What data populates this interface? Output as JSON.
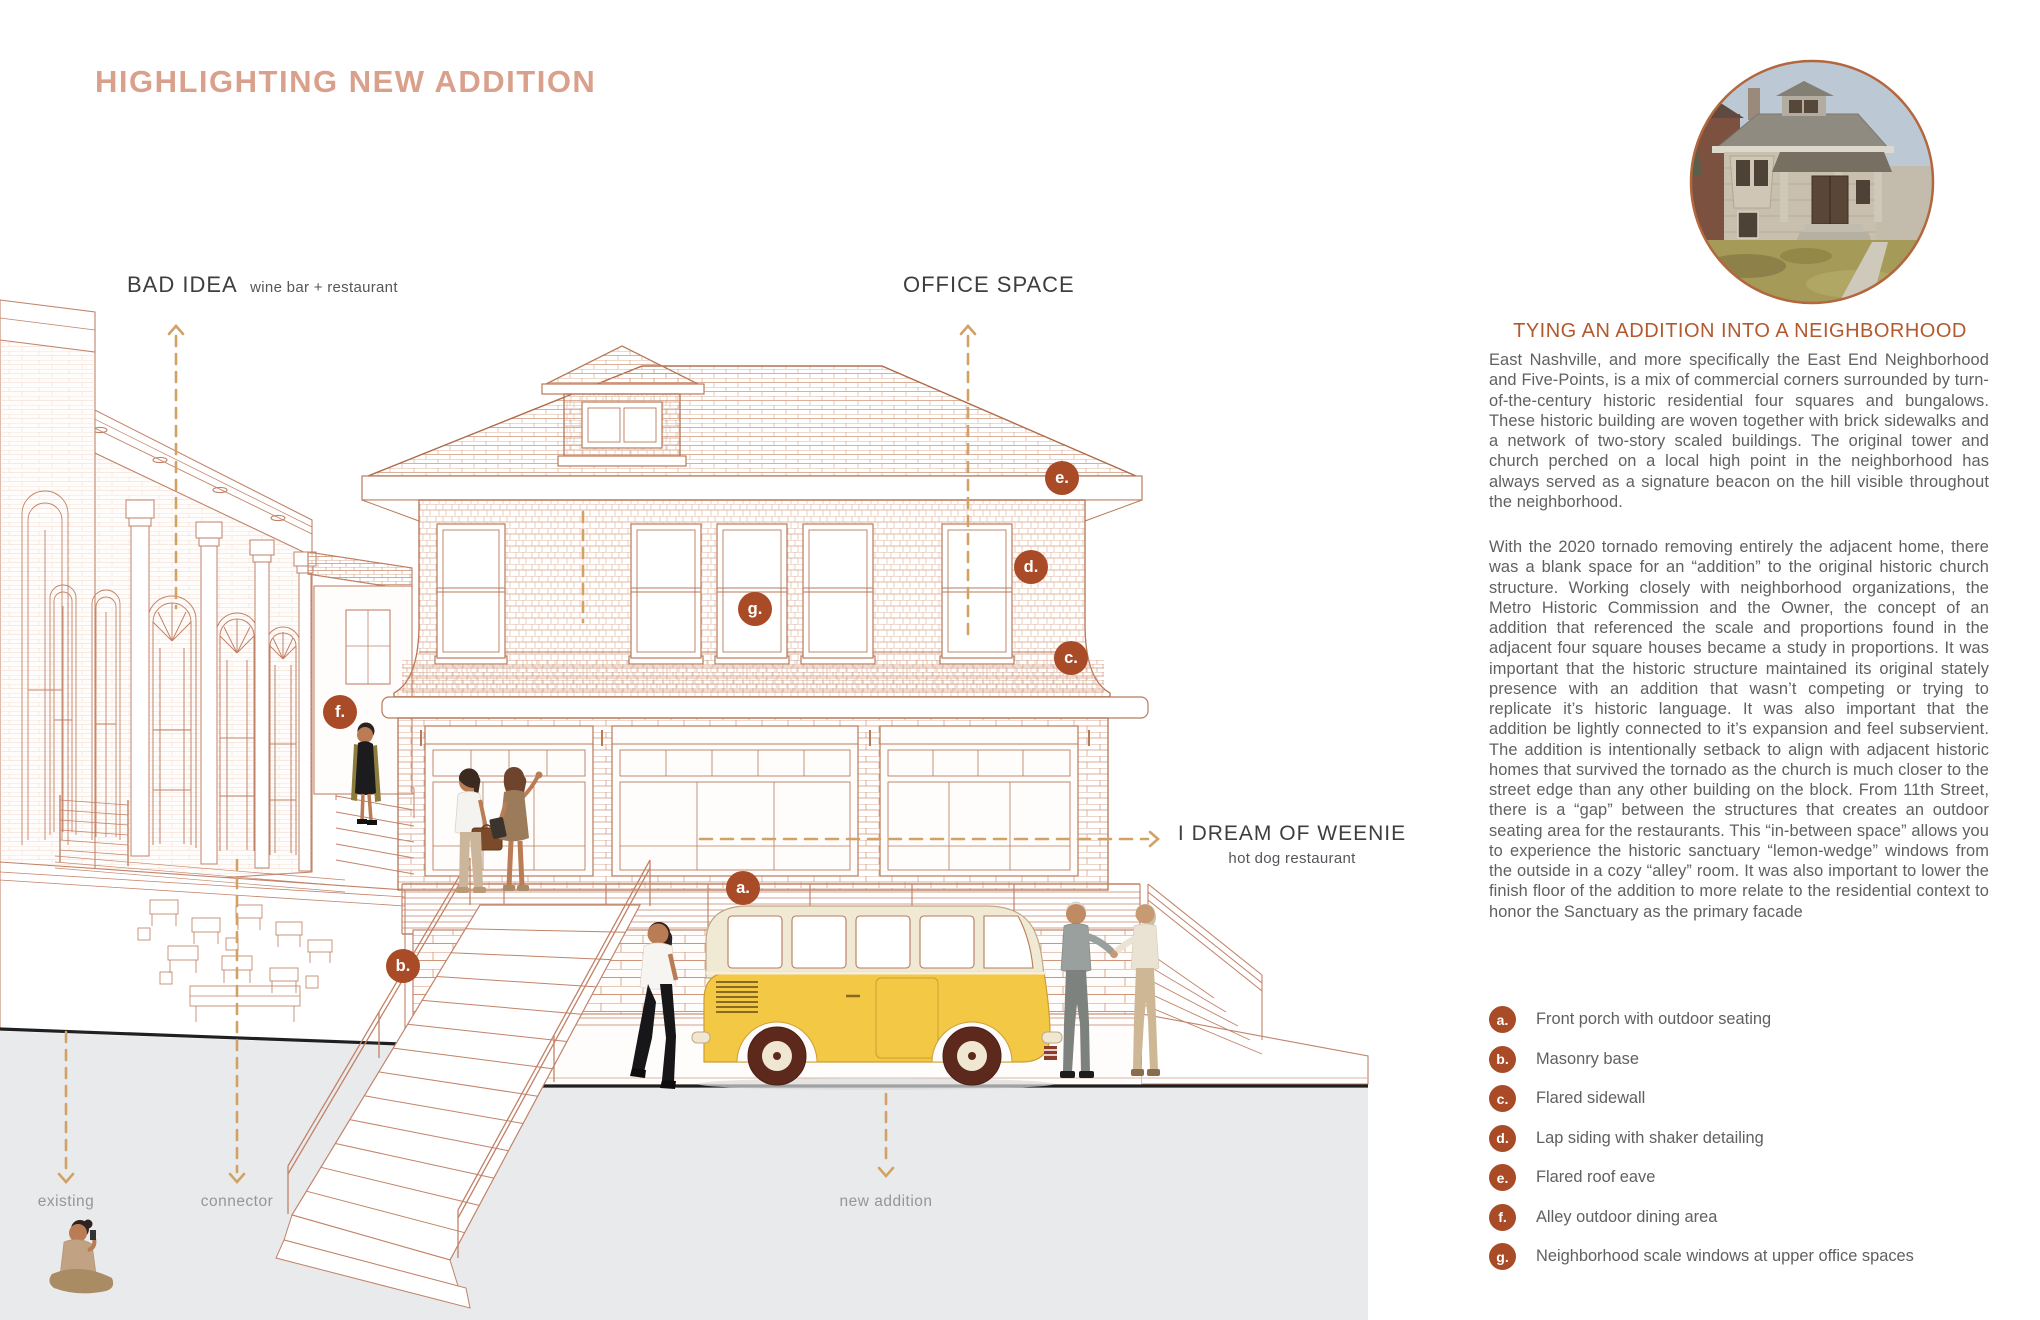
{
  "title": "HIGHLIGHTING NEW ADDITION",
  "drawing": {
    "labels": {
      "bad_idea_name": "BAD IDEA",
      "bad_idea_desc": "wine bar + restaurant",
      "office_space": "OFFICE SPACE",
      "weenie_name": "I DREAM OF WEENIE",
      "weenie_desc": "hot dog restaurant",
      "existing": "existing",
      "connector": "connector",
      "new_addition": "new addition"
    },
    "callouts": [
      {
        "letter": "a.",
        "x": 743,
        "y": 888
      },
      {
        "letter": "b.",
        "x": 403,
        "y": 966
      },
      {
        "letter": "c.",
        "x": 1071,
        "y": 658
      },
      {
        "letter": "d.",
        "x": 1031,
        "y": 567
      },
      {
        "letter": "e.",
        "x": 1062,
        "y": 478
      },
      {
        "letter": "f.",
        "x": 340,
        "y": 712
      },
      {
        "letter": "g.",
        "x": 755,
        "y": 609
      }
    ]
  },
  "sidebar": {
    "heading": "TYING AN ADDITION INTO A NEIGHBORHOOD",
    "paragraphs": [
      "East Nashville, and more specifically the East End Neighborhood and Five-Points, is a mix of commercial corners surrounded by turn-of-the-century historic residential four squares and bungalows.  These historic building are woven together with brick sidewalks and a network of two-story scaled buildings.  The original tower and church perched on a local high point in the neighborhood has always served as a signature beacon on the hill visible throughout the neighborhood.",
      "With the 2020 tornado removing entirely the adjacent home, there was a blank space for an “addition” to the original historic church structure.  Working closely with neighborhood organizations, the Metro Historic Commission and the Owner, the concept of an addition that referenced the scale and proportions found in the adjacent four square houses became a study in proportions.  It was important that the historic structure maintained its original stately presence with an addition that wasn’t competing or trying to replicate it’s historic language.  It was also important that the addition be lightly connected to it’s expansion and feel subservient.  The addition is intentionally setback to align with adjacent historic homes that survived the tornado as the church is much closer to the street edge than any other building on the block.  From 11th Street, there is a “gap” between the structures that creates an outdoor seating area for the restaurants.  This “in-between space” allows you to experience the historic sanctuary “lemon-wedge” windows from the outside in a cozy “alley” room.  It was also important to lower the finish floor of the addition to more relate to the residential context to honor the Sanctuary as the primary facade"
    ],
    "legend": [
      {
        "letter": "a.",
        "label": "Front porch with outdoor seating"
      },
      {
        "letter": "b.",
        "label": "Masonry base"
      },
      {
        "letter": "c.",
        "label": "Flared sidewall"
      },
      {
        "letter": "d.",
        "label": "Lap siding with shaker detailing"
      },
      {
        "letter": "e.",
        "label": "Flared roof eave"
      },
      {
        "letter": "f.",
        "label": "Alley outdoor dining area"
      },
      {
        "letter": "g.",
        "label": "Neighborhood scale windows at upper office spaces"
      }
    ]
  },
  "colors": {
    "accent_rust": "#a84b26",
    "title_pink": "#d9a08b",
    "heading_rust": "#b2592e",
    "leader_tan": "#d2a265",
    "line_salmon": "#c28268",
    "bus_yellow": "#f3c845",
    "pavement_grey": "#e9eaec"
  }
}
